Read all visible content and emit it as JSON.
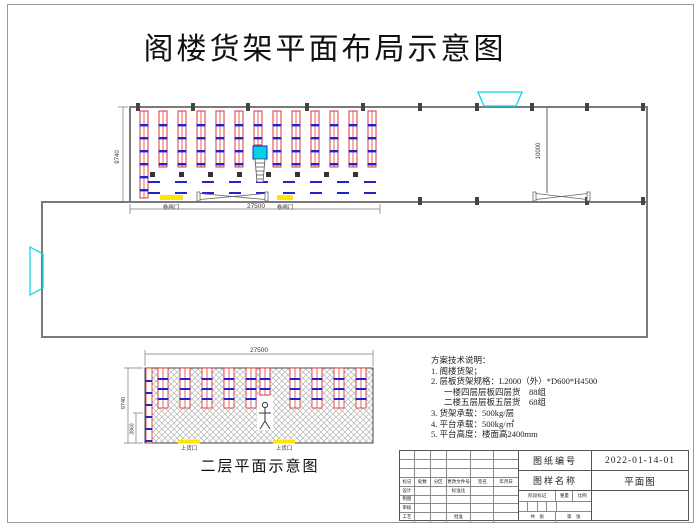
{
  "title": "阁楼货架平面布局示意图",
  "colors": {
    "rack_red": "#dd2222",
    "beam_blue": "#2323cc",
    "dock_cyan": "#00d4e4",
    "door_yellow": "#ffe400",
    "wall_gray": "#7a7a7a",
    "hatch_gray": "#b5b5b5",
    "column_dark": "#444444"
  },
  "top_plan": {
    "rack_count": 13,
    "dim_left": "9740",
    "dim_bottom": "27500",
    "dim_right": "10000",
    "door_left_label": "卷闸门",
    "door_right_label": "卷闸门"
  },
  "bottom_plan": {
    "rack_group_count": 10,
    "dim_top": "27500",
    "dim_left": "9740",
    "dim_inner": "3860",
    "loading_left": "上货口",
    "loading_right": "上货口",
    "caption": "二层平面示意图"
  },
  "notes": {
    "lines": [
      "方案技术说明：",
      "1. 阁楼货架；",
      "2. 层板货架规格：L2000（外）*D600*H4500",
      "一楼四层层板四层货　88组",
      "二楼五层层板五层货　68组",
      "3. 货架承载：500kg/层",
      "4. 平台承载：500kg/㎡",
      "5. 平台高度：楼面高2400mm"
    ]
  },
  "title_block": {
    "labels": {
      "drawing_no": "图纸编号",
      "drawing_name": "图样名称",
      "stage": "阶段标记",
      "weight": "重量",
      "scale": "比例",
      "sheets": "共　张",
      "sheet_no": "第　张",
      "mark": "标记",
      "count": "处数",
      "zone": "分区",
      "change_doc": "更改文件号",
      "sign": "签名",
      "date": "年月日",
      "design": "设计",
      "draft": "制图",
      "audit": "审核",
      "craft": "工艺",
      "standard": "标准化",
      "approve": "批准"
    },
    "values": {
      "drawing_no": "2022-01-14-01",
      "drawing_name": "平面图"
    }
  }
}
